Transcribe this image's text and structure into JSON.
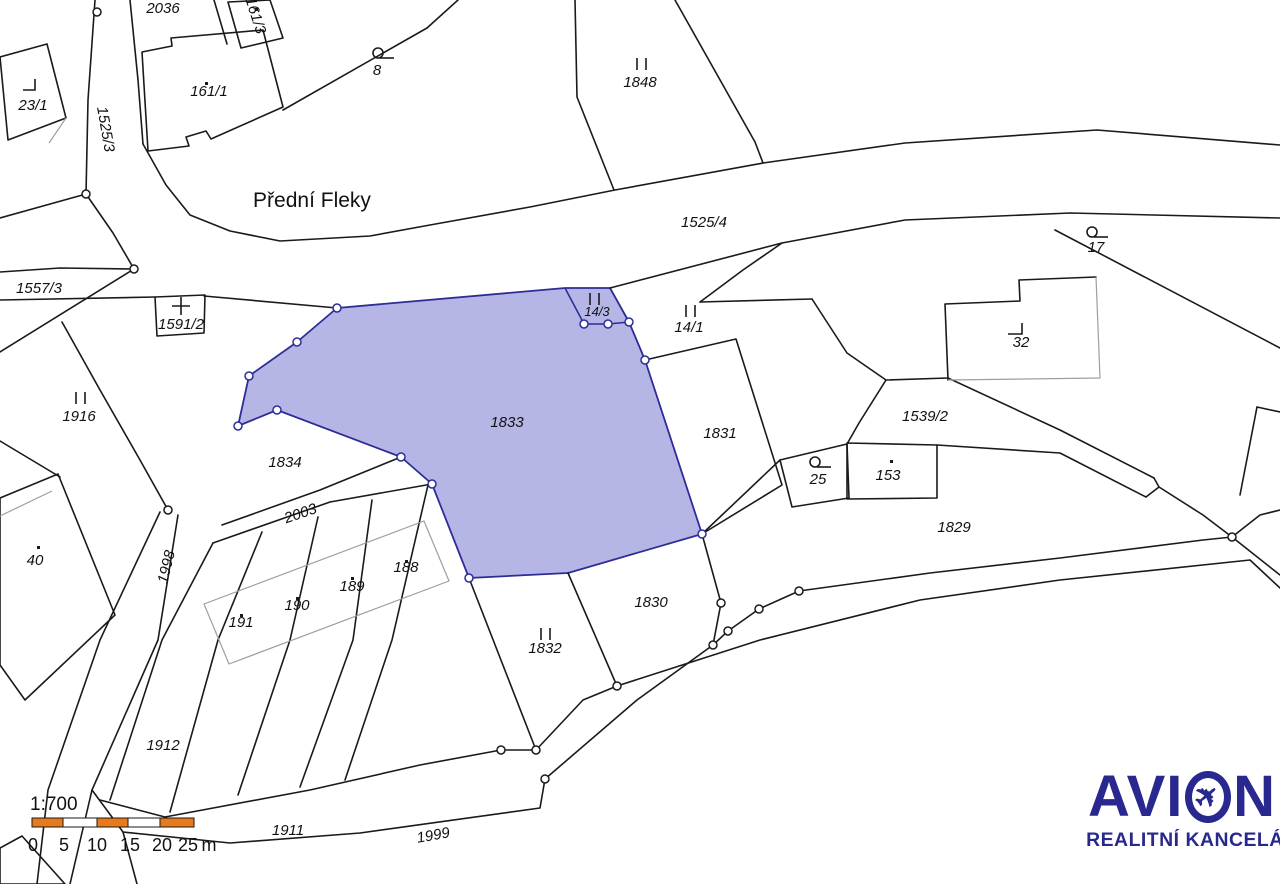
{
  "map": {
    "type": "cadastral-map",
    "street_name": "Přední Fleky",
    "highlighted_parcel": "1833",
    "labels": {
      "p2036": "2036",
      "p161_3": "161/3",
      "p23_1": "23/1",
      "p1525_3": "1525/3",
      "p161_1": "161/1",
      "p8": "8",
      "p1848": "1848",
      "p1525_4": "1525/4",
      "p17": "17",
      "p1557_3": "1557/3",
      "p1591_2": "1591/2",
      "p1916": "1916",
      "p14_3": "14/3",
      "p14_1": "14/1",
      "p1833": "1833",
      "p1831": "1831",
      "p32": "32",
      "p1539_2": "1539/2",
      "p25": "25",
      "p153": "153",
      "p1829": "1829",
      "p1834": "1834",
      "p2003": "2003",
      "p1998": "1998",
      "p40": "40",
      "p191": "191",
      "p190": "190",
      "p189": "189",
      "p188": "188",
      "p1832": "1832",
      "p1830": "1830",
      "p1912": "1912",
      "p1911": "1911",
      "p1999": "1999"
    }
  },
  "scale": {
    "ratio": "1:700",
    "t0": "0",
    "t1": "5",
    "t2": "10",
    "t3": "15",
    "t4": "20",
    "t5": "25",
    "unit": "m"
  },
  "logo": {
    "name_prefix": "AVI",
    "name_suffix": "N",
    "full_name": "AVION",
    "subtitle": "REALITNÍ KANCELÁŘ"
  },
  "colors": {
    "highlight_fill": "#b6b6e6",
    "highlight_stroke": "#2d2d96",
    "line": "#1a1a1a",
    "gray_line": "#9e9e9e",
    "scale_orange": "#e8791d",
    "logo_navy": "#28288e"
  }
}
